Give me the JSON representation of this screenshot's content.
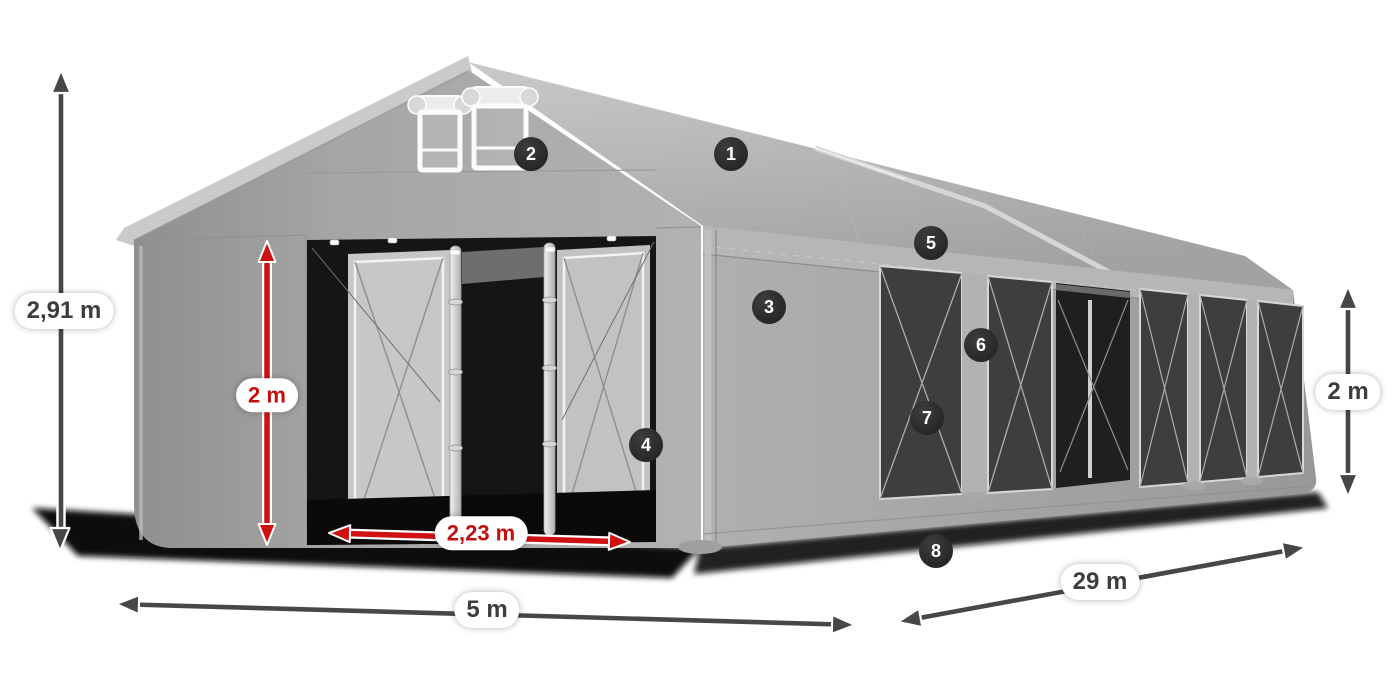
{
  "diagram": {
    "type": "product-dimension-diagram",
    "background": "#ffffff"
  },
  "dimensions": {
    "total_height": "2,91 m",
    "entrance_height": "2 m",
    "entrance_width": "2,23 m",
    "width": "5 m",
    "length": "29 m",
    "side_height": "2 m"
  },
  "feature_markers": [
    "1",
    "2",
    "3",
    "4",
    "5",
    "6",
    "7",
    "8"
  ],
  "colors": {
    "entrance_dimension_red": "#c21010",
    "overall_dimension_gray": "#474747",
    "marker_badge_background": "#2e2e2e",
    "marker_badge_text": "#ffffff",
    "label_pill_background": "#ffffff",
    "label_pill_text": "#3d3d3d",
    "tent_roof_gray": "#c2c2c2",
    "tent_wall_gray": "#a6a6a6",
    "window_mesh_dark": "#3e3e3e"
  }
}
